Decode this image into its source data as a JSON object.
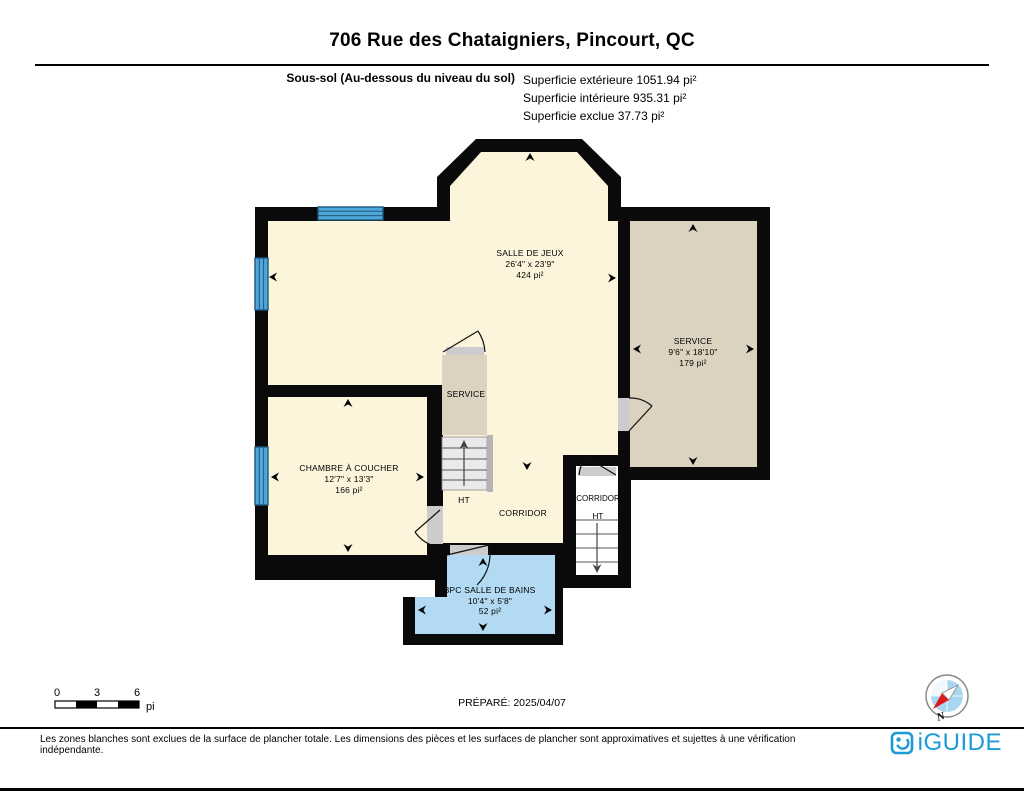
{
  "header": {
    "title": "706 Rue des Chataigniers, Pincourt, QC",
    "floor_label": "Sous-sol (Au-dessous du niveau du sol)",
    "area_line1": "Superficie extérieure 1051.94 pi²",
    "area_line2": "Superficie intérieure 935.31 pi²",
    "area_line3": "Superficie exclue 37.73 pi²"
  },
  "plan": {
    "salle_de_jeux": {
      "name": "SALLE DE JEUX",
      "dims": "26'4\" x 23'9\"",
      "area": "424 pi²"
    },
    "service_right": {
      "name": "SERVICE",
      "dims": "9'6\" x 18'10\"",
      "area": "179 pi²"
    },
    "chambre": {
      "name": "CHAMBRE À COUCHER",
      "dims": "12'7\" x 13'3\"",
      "area": "166 pi²"
    },
    "salle_de_bains": {
      "name": "3PC SALLE DE BAINS",
      "dims": "10'4\" x 5'8\"",
      "area": "52 pi²"
    },
    "service_closet": {
      "name": "SERVICE"
    },
    "corridor": {
      "name": "CORRIDOR"
    },
    "corridor_ht": {
      "name": "CORRIDOR",
      "sub": "HT"
    },
    "stair_label": "HT"
  },
  "scale_bar": {
    "tick0": "0",
    "tick1": "3",
    "tick2": "6",
    "unit": "pi"
  },
  "prepared": "PRÉPARÉ: 2025/04/07",
  "compass": {
    "north_label": "N"
  },
  "footer": {
    "disclaimer": "Les zones blanches sont exclues de la surface de plancher totale. Les dimensions des pièces et les surfaces de plancher sont approximatives et sujettes à une vérification indépendante.",
    "brand": "iGUIDE"
  },
  "colors": {
    "room_cream": "#FCF5DC",
    "room_tan": "#DCD2C0",
    "room_blue": "#B2DBF3",
    "window_blue": "#4FA6D9",
    "wall": "#0A0A0A",
    "brand_blue": "#1B9BD7"
  }
}
